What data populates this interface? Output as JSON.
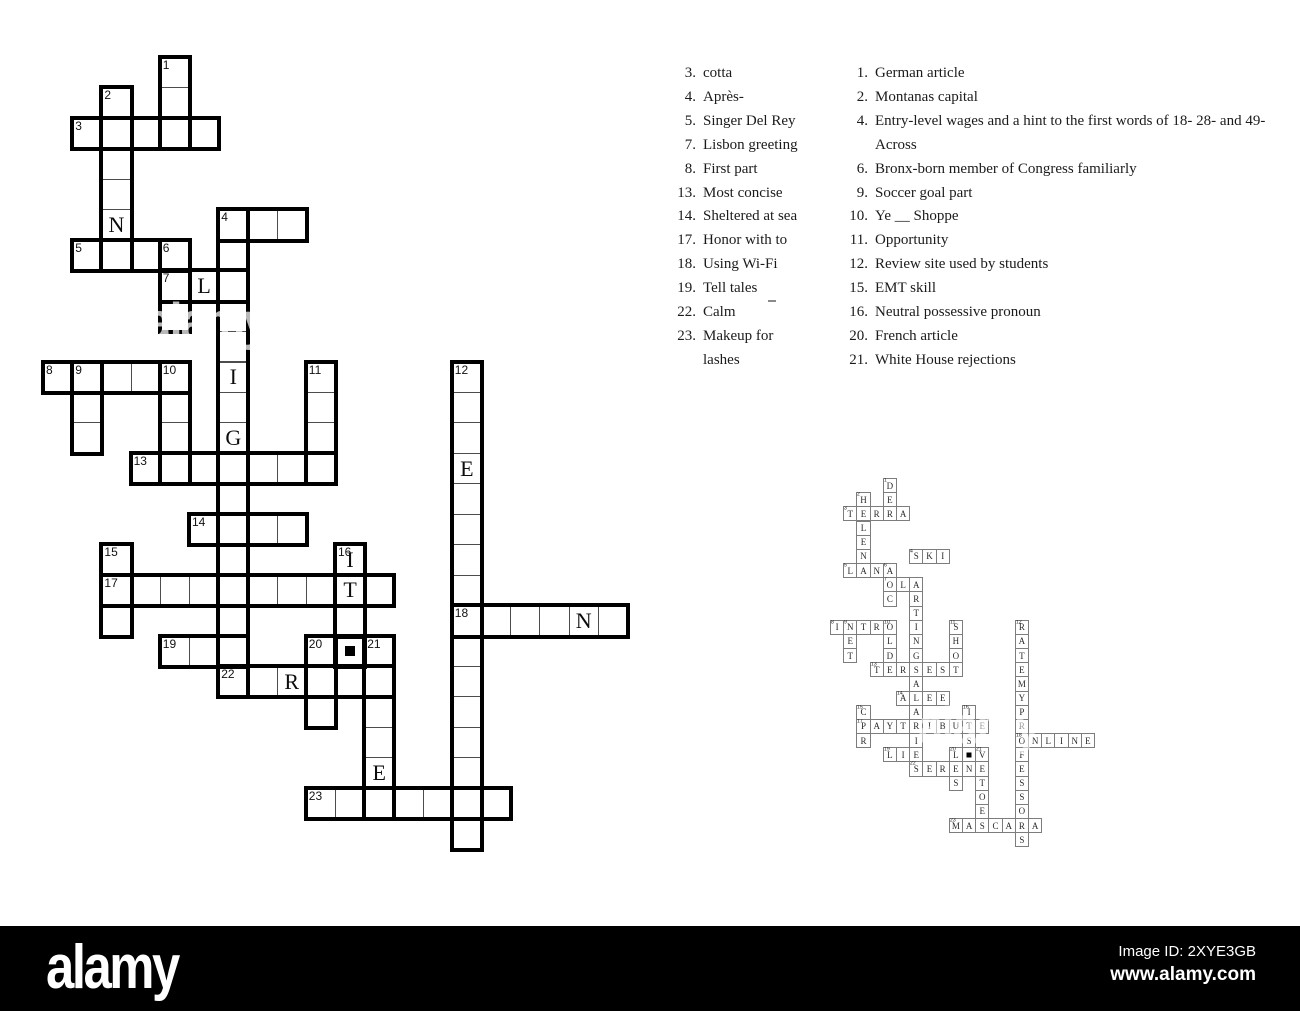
{
  "watermark_bar": {
    "logo": "alamy",
    "image_id": "Image ID: 2XYE3GB",
    "url": "www.alamy.com",
    "bar_color": "#000000",
    "text_color": "#ffffff"
  },
  "ghost_watermark_label": "alamy",
  "clues_across": {
    "items": [
      {
        "num": "3.",
        "text": "cotta"
      },
      {
        "num": "4.",
        "text": "Après-"
      },
      {
        "num": "5.",
        "text": "Singer Del Rey"
      },
      {
        "num": "7.",
        "text": "Lisbon greeting"
      },
      {
        "num": "8.",
        "text": "First part"
      },
      {
        "num": "13.",
        "text": "Most concise"
      },
      {
        "num": "14.",
        "text": "Sheltered at sea"
      },
      {
        "num": "17.",
        "text": "Honor with to"
      },
      {
        "num": "18.",
        "text": "Using Wi-Fi"
      },
      {
        "num": "19.",
        "text": "Tell tales"
      },
      {
        "num": "22.",
        "text": "Calm"
      },
      {
        "num": "23.",
        "text": "Makeup for\nlashes"
      }
    ]
  },
  "clues_down": {
    "items": [
      {
        "num": "1.",
        "text": "German article"
      },
      {
        "num": "2.",
        "text": "Montanas capital"
      },
      {
        "num": "4.",
        "text": "Entry-level wages and a hint to the first words of 18- 28- and 49-\nAcross"
      },
      {
        "num": "6.",
        "text": "Bronx-born member of Congress familiarly"
      },
      {
        "num": "9.",
        "text": "Soccer goal part"
      },
      {
        "num": "10.",
        "text": "Ye __ Shoppe"
      },
      {
        "num": "11.",
        "text": "Opportunity"
      },
      {
        "num": "12.",
        "text": "Review site used by students"
      },
      {
        "num": "15.",
        "text": "EMT skill"
      },
      {
        "num": "16.",
        "text": "Neutral possessive pronoun"
      },
      {
        "num": "20.",
        "text": "French article"
      },
      {
        "num": "21.",
        "text": "White House rejections"
      }
    ]
  },
  "big_grid": {
    "x0": 43,
    "y0": 57,
    "cw": 29.2,
    "ch": 30.45
  },
  "solution_grid": {
    "x0": 830,
    "y0": 478,
    "cw": 13.2,
    "ch": 14.17
  },
  "cells": [
    [
      0,
      4,
      "D",
      1,
      0
    ],
    [
      1,
      2,
      "H",
      2,
      0
    ],
    [
      1,
      4,
      "E",
      0,
      0
    ],
    [
      2,
      1,
      "T",
      3,
      0
    ],
    [
      2,
      2,
      "E",
      0,
      0
    ],
    [
      2,
      3,
      "R",
      0,
      0
    ],
    [
      2,
      4,
      "R",
      0,
      0
    ],
    [
      2,
      5,
      "A",
      0,
      0
    ],
    [
      3,
      2,
      "L",
      0,
      0
    ],
    [
      4,
      2,
      "E",
      0,
      0
    ],
    [
      5,
      2,
      "N",
      0,
      1
    ],
    [
      5,
      6,
      "S",
      4,
      0
    ],
    [
      5,
      7,
      "K",
      0,
      0
    ],
    [
      5,
      8,
      "I",
      0,
      0
    ],
    [
      6,
      1,
      "L",
      5,
      0
    ],
    [
      6,
      2,
      "A",
      0,
      0
    ],
    [
      6,
      3,
      "N",
      0,
      0
    ],
    [
      6,
      4,
      "A",
      6,
      0
    ],
    [
      7,
      4,
      "O",
      7,
      0
    ],
    [
      7,
      5,
      "L",
      0,
      1
    ],
    [
      7,
      6,
      "A",
      0,
      0
    ],
    [
      8,
      4,
      "C",
      0,
      0
    ],
    [
      8,
      6,
      "R",
      0,
      0
    ],
    [
      9,
      6,
      "T",
      0,
      0
    ],
    [
      10,
      0,
      "I",
      8,
      0
    ],
    [
      10,
      1,
      "N",
      9,
      0
    ],
    [
      10,
      2,
      "T",
      0,
      0
    ],
    [
      10,
      3,
      "R",
      0,
      0
    ],
    [
      10,
      4,
      "O",
      10,
      0
    ],
    [
      10,
      6,
      "I",
      0,
      1
    ],
    [
      10,
      9,
      "S",
      11,
      0
    ],
    [
      10,
      14,
      "R",
      12,
      0
    ],
    [
      11,
      1,
      "E",
      0,
      0
    ],
    [
      11,
      4,
      "L",
      0,
      0
    ],
    [
      11,
      6,
      "N",
      0,
      0
    ],
    [
      11,
      9,
      "H",
      0,
      0
    ],
    [
      11,
      14,
      "A",
      0,
      0
    ],
    [
      12,
      1,
      "T",
      0,
      0
    ],
    [
      12,
      4,
      "D",
      0,
      0
    ],
    [
      12,
      6,
      "G",
      0,
      1
    ],
    [
      12,
      9,
      "O",
      0,
      0
    ],
    [
      12,
      14,
      "T",
      0,
      0
    ],
    [
      13,
      3,
      "T",
      13,
      0
    ],
    [
      13,
      4,
      "E",
      0,
      0
    ],
    [
      13,
      5,
      "R",
      0,
      0
    ],
    [
      13,
      6,
      "S",
      0,
      0
    ],
    [
      13,
      7,
      "E",
      0,
      0
    ],
    [
      13,
      8,
      "S",
      0,
      0
    ],
    [
      13,
      9,
      "T",
      0,
      0
    ],
    [
      13,
      14,
      "E",
      0,
      1
    ],
    [
      14,
      6,
      "A",
      0,
      0
    ],
    [
      14,
      14,
      "M",
      0,
      0
    ],
    [
      15,
      5,
      "A",
      14,
      0
    ],
    [
      15,
      6,
      "L",
      0,
      0
    ],
    [
      15,
      7,
      "E",
      0,
      0
    ],
    [
      15,
      8,
      "E",
      0,
      0
    ],
    [
      15,
      14,
      "Y",
      0,
      0
    ],
    [
      16,
      2,
      "C",
      15,
      0
    ],
    [
      16,
      6,
      "A",
      0,
      0
    ],
    [
      16,
      10,
      "I",
      16,
      1
    ],
    [
      16,
      14,
      "P",
      0,
      0
    ],
    [
      17,
      2,
      "P",
      17,
      0
    ],
    [
      17,
      3,
      "A",
      0,
      0
    ],
    [
      17,
      4,
      "Y",
      0,
      0
    ],
    [
      17,
      5,
      "T",
      0,
      0
    ],
    [
      17,
      6,
      "R",
      0,
      0
    ],
    [
      17,
      7,
      "I",
      0,
      0
    ],
    [
      17,
      8,
      "B",
      0,
      0
    ],
    [
      17,
      9,
      "U",
      0,
      0
    ],
    [
      17,
      10,
      "T",
      0,
      1
    ],
    [
      17,
      11,
      "E",
      0,
      0
    ],
    [
      17,
      14,
      "R",
      0,
      0
    ],
    [
      18,
      2,
      "R",
      0,
      0
    ],
    [
      18,
      6,
      "I",
      0,
      0
    ],
    [
      18,
      10,
      "S",
      0,
      0
    ],
    [
      18,
      14,
      "O",
      18,
      0
    ],
    [
      18,
      15,
      "N",
      0,
      0
    ],
    [
      18,
      16,
      "L",
      0,
      0
    ],
    [
      18,
      17,
      "I",
      0,
      0
    ],
    [
      18,
      18,
      "N",
      0,
      1
    ],
    [
      18,
      19,
      "E",
      0,
      0
    ],
    [
      19,
      4,
      "L",
      19,
      0
    ],
    [
      19,
      5,
      "I",
      0,
      0
    ],
    [
      19,
      6,
      "E",
      0,
      0
    ],
    [
      19,
      9,
      "L",
      20,
      0
    ],
    [
      19,
      10,
      "",
      0,
      2
    ],
    [
      19,
      11,
      "V",
      21,
      0
    ],
    [
      19,
      14,
      "F",
      0,
      0
    ],
    [
      20,
      6,
      "S",
      22,
      0
    ],
    [
      20,
      7,
      "E",
      0,
      0
    ],
    [
      20,
      8,
      "R",
      0,
      1
    ],
    [
      20,
      9,
      "E",
      0,
      0
    ],
    [
      20,
      10,
      "N",
      0,
      0
    ],
    [
      20,
      11,
      "E",
      0,
      0
    ],
    [
      20,
      14,
      "E",
      0,
      0
    ],
    [
      21,
      9,
      "S",
      0,
      0
    ],
    [
      21,
      11,
      "T",
      0,
      0
    ],
    [
      21,
      14,
      "S",
      0,
      0
    ],
    [
      22,
      11,
      "O",
      0,
      0
    ],
    [
      22,
      14,
      "S",
      0,
      0
    ],
    [
      23,
      11,
      "E",
      0,
      1
    ],
    [
      23,
      14,
      "O",
      0,
      0
    ],
    [
      24,
      9,
      "M",
      23,
      0
    ],
    [
      24,
      10,
      "A",
      0,
      0
    ],
    [
      24,
      11,
      "S",
      0,
      0
    ],
    [
      24,
      12,
      "C",
      0,
      0
    ],
    [
      24,
      13,
      "A",
      0,
      0
    ],
    [
      24,
      14,
      "R",
      0,
      0
    ],
    [
      24,
      15,
      "A",
      0,
      0
    ],
    [
      25,
      14,
      "S",
      0,
      0
    ]
  ],
  "entries": [
    [
      2,
      1,
      5,
      "a"
    ],
    [
      5,
      6,
      3,
      "a"
    ],
    [
      6,
      1,
      4,
      "a"
    ],
    [
      7,
      4,
      3,
      "a"
    ],
    [
      10,
      0,
      5,
      "a"
    ],
    [
      13,
      3,
      7,
      "a"
    ],
    [
      15,
      5,
      4,
      "a"
    ],
    [
      17,
      2,
      10,
      "a"
    ],
    [
      18,
      14,
      6,
      "a"
    ],
    [
      19,
      4,
      3,
      "a"
    ],
    [
      20,
      6,
      6,
      "a"
    ],
    [
      24,
      9,
      7,
      "a"
    ],
    [
      0,
      4,
      3,
      "d"
    ],
    [
      1,
      2,
      6,
      "d"
    ],
    [
      5,
      6,
      16,
      "d"
    ],
    [
      6,
      4,
      3,
      "d"
    ],
    [
      10,
      1,
      3,
      "d"
    ],
    [
      10,
      4,
      4,
      "d"
    ],
    [
      10,
      9,
      4,
      "d"
    ],
    [
      10,
      14,
      16,
      "d"
    ],
    [
      16,
      2,
      3,
      "d"
    ],
    [
      16,
      10,
      3,
      "d"
    ],
    [
      19,
      9,
      3,
      "d"
    ],
    [
      19,
      11,
      6,
      "d"
    ],
    [
      19,
      10,
      1,
      "a"
    ]
  ]
}
